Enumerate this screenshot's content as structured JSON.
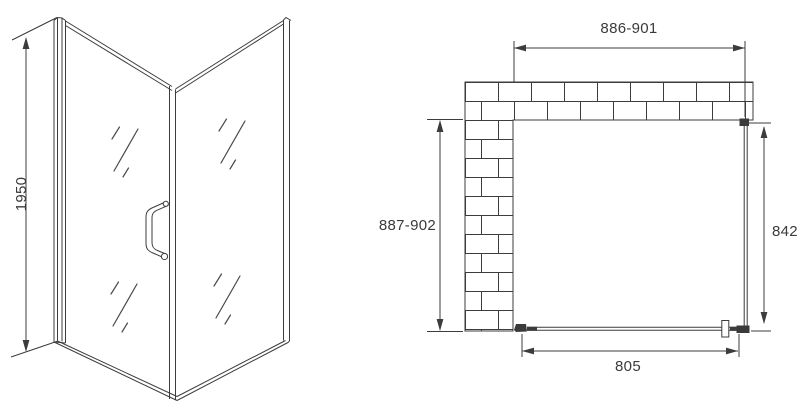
{
  "meta": {
    "type": "technical-dimension-drawing",
    "subject": "corner shower enclosure with hinged glass door and side panel",
    "background_color": "#ffffff",
    "line_color": "#3c3c3c",
    "text_color": "#3a3a3a"
  },
  "perspective_view": {
    "description": "3D perspective of glass door with wall profile, corner post and handle",
    "dimensions": {
      "height": "1950"
    }
  },
  "plan_view": {
    "description": "top view with L-shaped brick wall, fixed side panel and door glass",
    "dimensions": {
      "opening_width": "886-901",
      "opening_depth": "887-902",
      "side_panel": "842",
      "door_glass": "805"
    }
  }
}
